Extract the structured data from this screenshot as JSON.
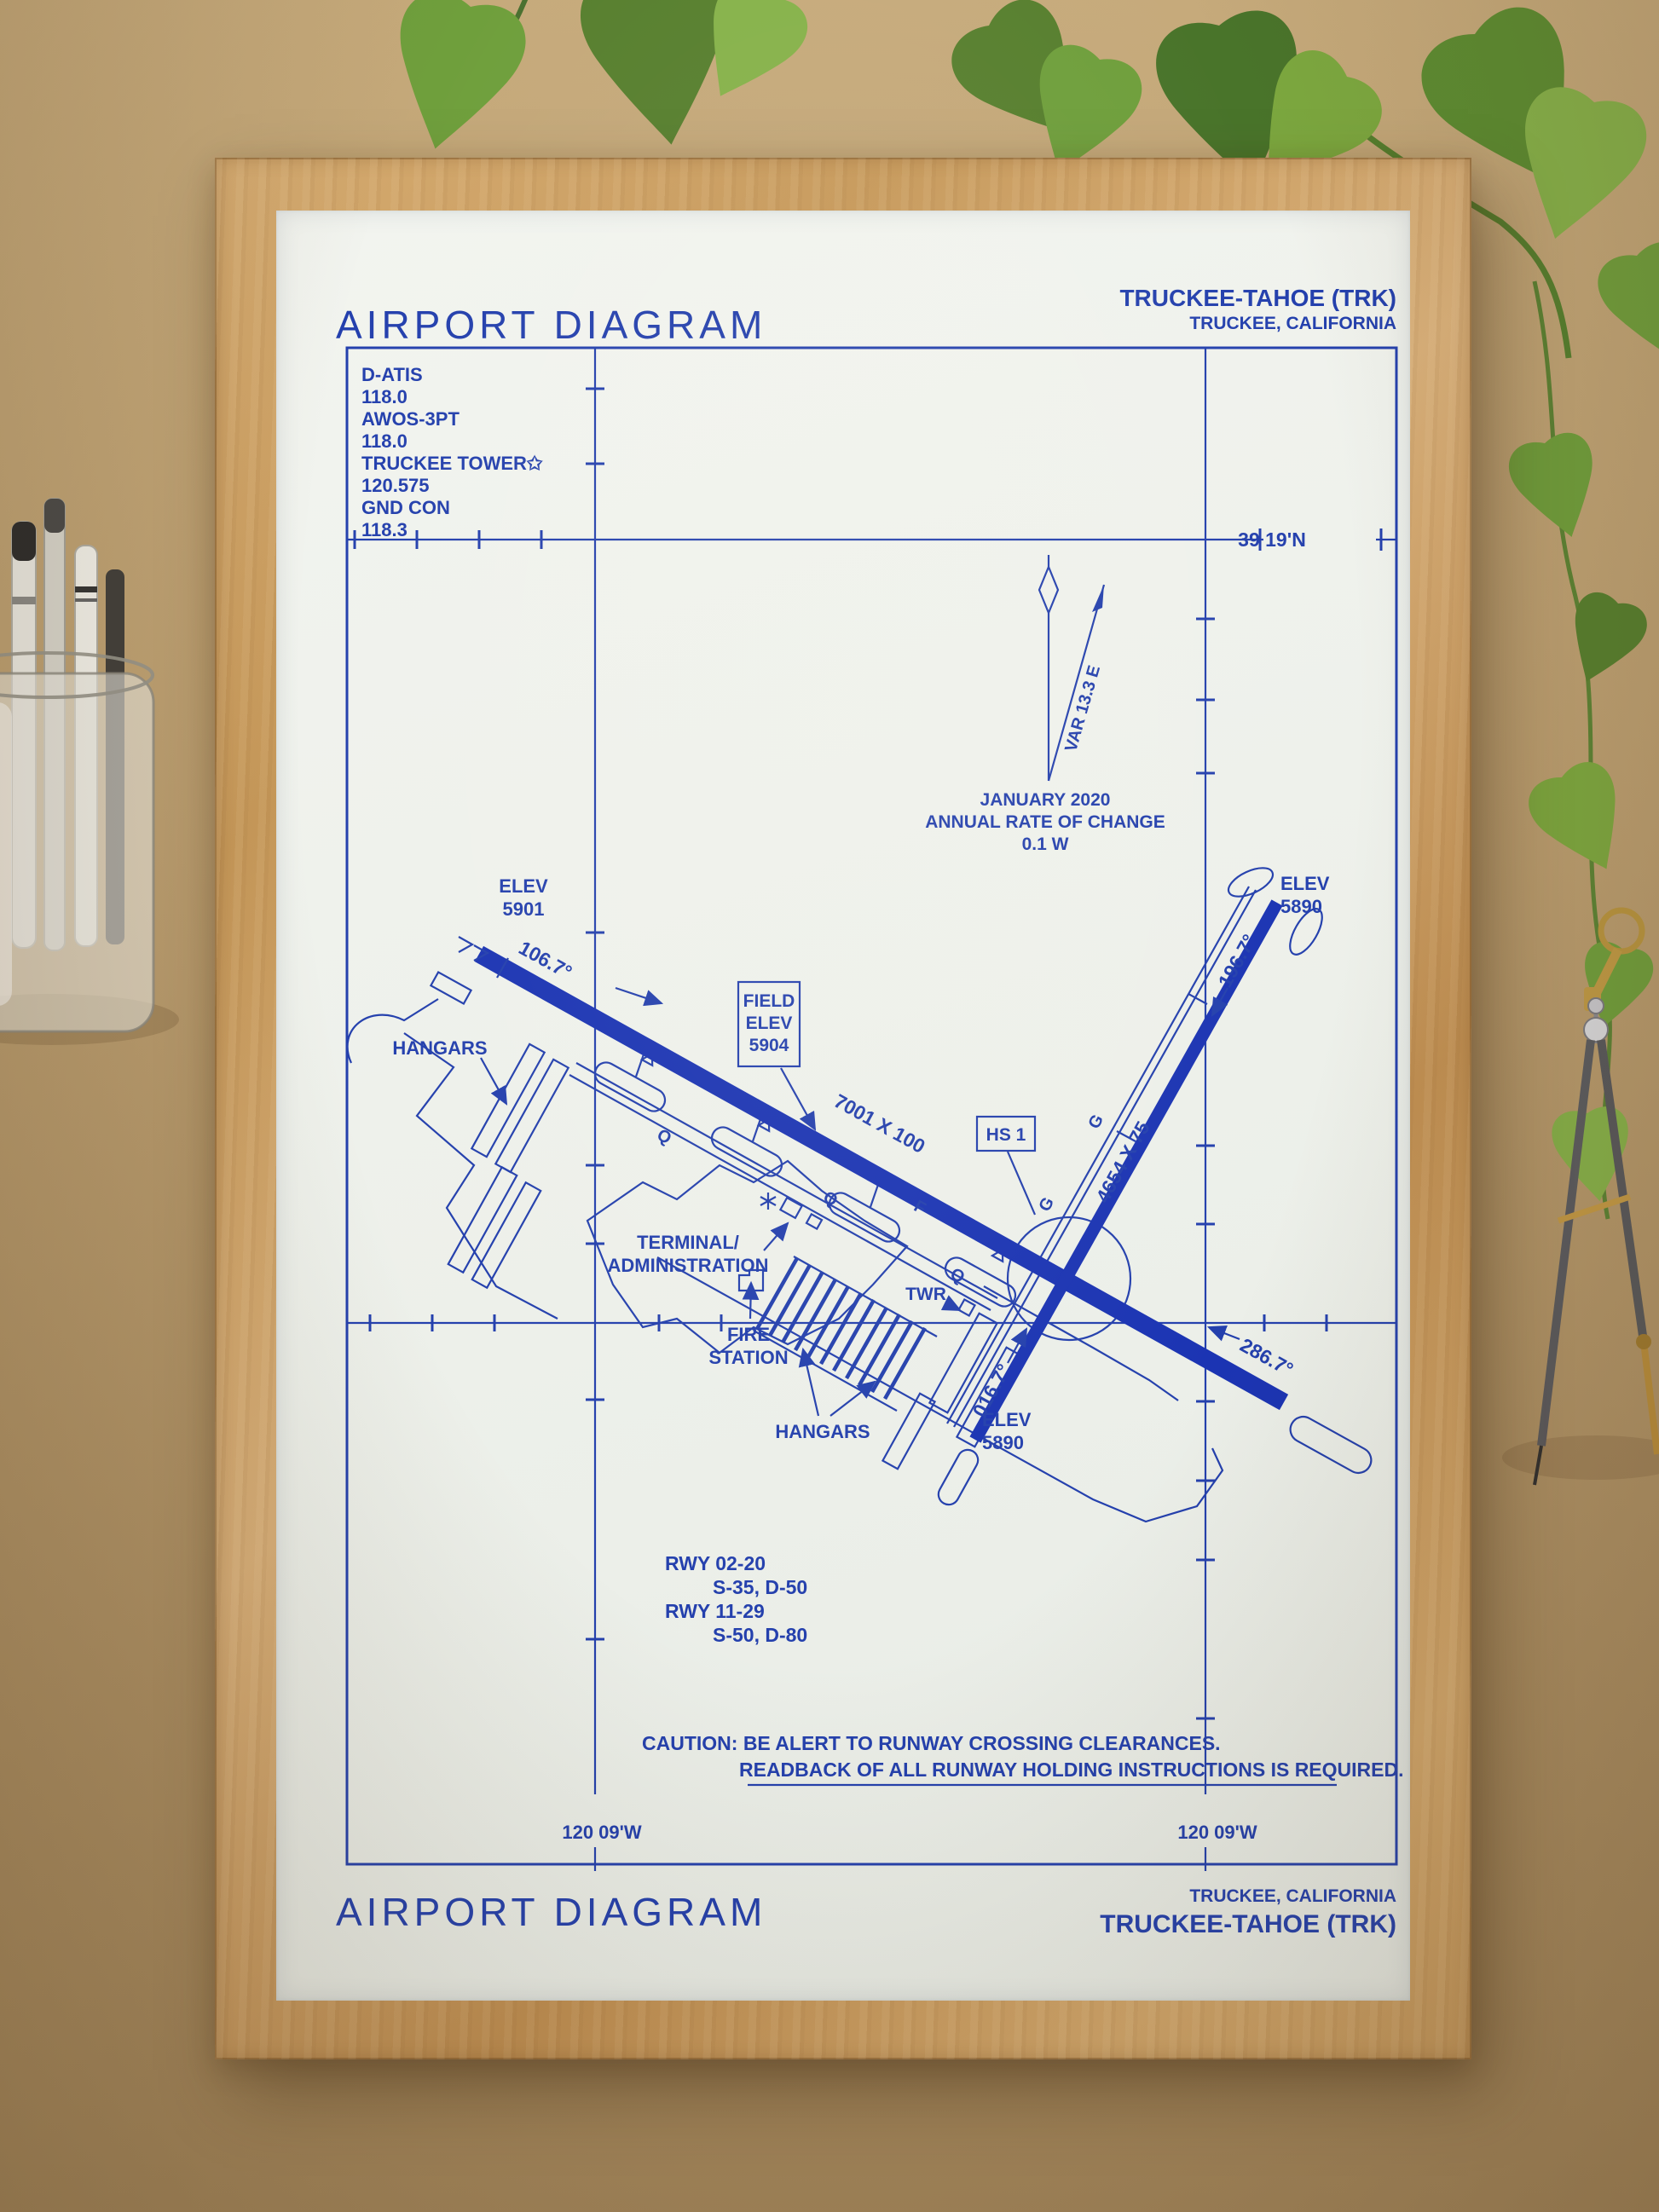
{
  "colors": {
    "ink": "#2440ad",
    "runway_fill": "#1b34b3",
    "paper": "#eef1ec",
    "frame_wood": "#c69859",
    "board": "#bb9e70",
    "leaf_green": "#6f9f3c",
    "brass": "#bb8f3c"
  },
  "header": {
    "title": "AIRPORT DIAGRAM",
    "airport": "TRUCKEE-TAHOE (TRK)",
    "city": "TRUCKEE, CALIFORNIA"
  },
  "footer": {
    "title": "AIRPORT DIAGRAM",
    "airport": "TRUCKEE-TAHOE (TRK)",
    "city": "TRUCKEE, CALIFORNIA"
  },
  "comms": {
    "lines": [
      "D-ATIS",
      "118.0",
      "AWOS-3PT",
      "118.0",
      "TRUCKEE TOWER✩",
      "120.575",
      "GND CON",
      "118.3"
    ]
  },
  "graticule": {
    "lat_label": "39 19'N",
    "lon_label_left": "120 09'W",
    "lon_label_right": "120 09'W"
  },
  "compass": {
    "variation": "VAR 13.3 E",
    "date": "JANUARY 2020",
    "rate_label": "ANNUAL RATE OF CHANGE",
    "rate_value": "0.1 W"
  },
  "field_elevation": {
    "line1": "FIELD",
    "line2": "ELEV",
    "line3": "5904"
  },
  "hot_spot": {
    "label": "HS 1"
  },
  "runways": {
    "rwy_11_29": {
      "dimensions": "7001 X 100",
      "heading_11": "106.7°",
      "heading_29": "286.7°",
      "elev_11_label": "ELEV",
      "elev_11_value": "5901"
    },
    "rwy_02_20": {
      "dimensions": "4654 X 75",
      "heading_02": "016.7°",
      "heading_20": "196.7°",
      "elev_20_label": "ELEV",
      "elev_20_value": "5890",
      "elev_02_label": "ELEV",
      "elev_02_value": "5890"
    }
  },
  "site_labels": {
    "hangars_nw": "HANGARS",
    "terminal_line1": "TERMINAL/",
    "terminal_line2": "ADMINISTRATION",
    "tower": "TWR",
    "fire_line1": "FIRE",
    "fire_line2": "STATION",
    "hangars_s": "HANGARS"
  },
  "taxiways": [
    "Q",
    "Q",
    "Q",
    "F",
    "G",
    "G"
  ],
  "runway_data": {
    "rwy1": "RWY 02-20",
    "rwy1_strength": "S-35, D-50",
    "rwy2": "RWY 11-29",
    "rwy2_strength": "S-50, D-80"
  },
  "caution": {
    "line1": "CAUTION: BE ALERT TO RUNWAY CROSSING CLEARANCES.",
    "line2": "READBACK OF ALL RUNWAY HOLDING INSTRUCTIONS IS REQUIRED."
  }
}
